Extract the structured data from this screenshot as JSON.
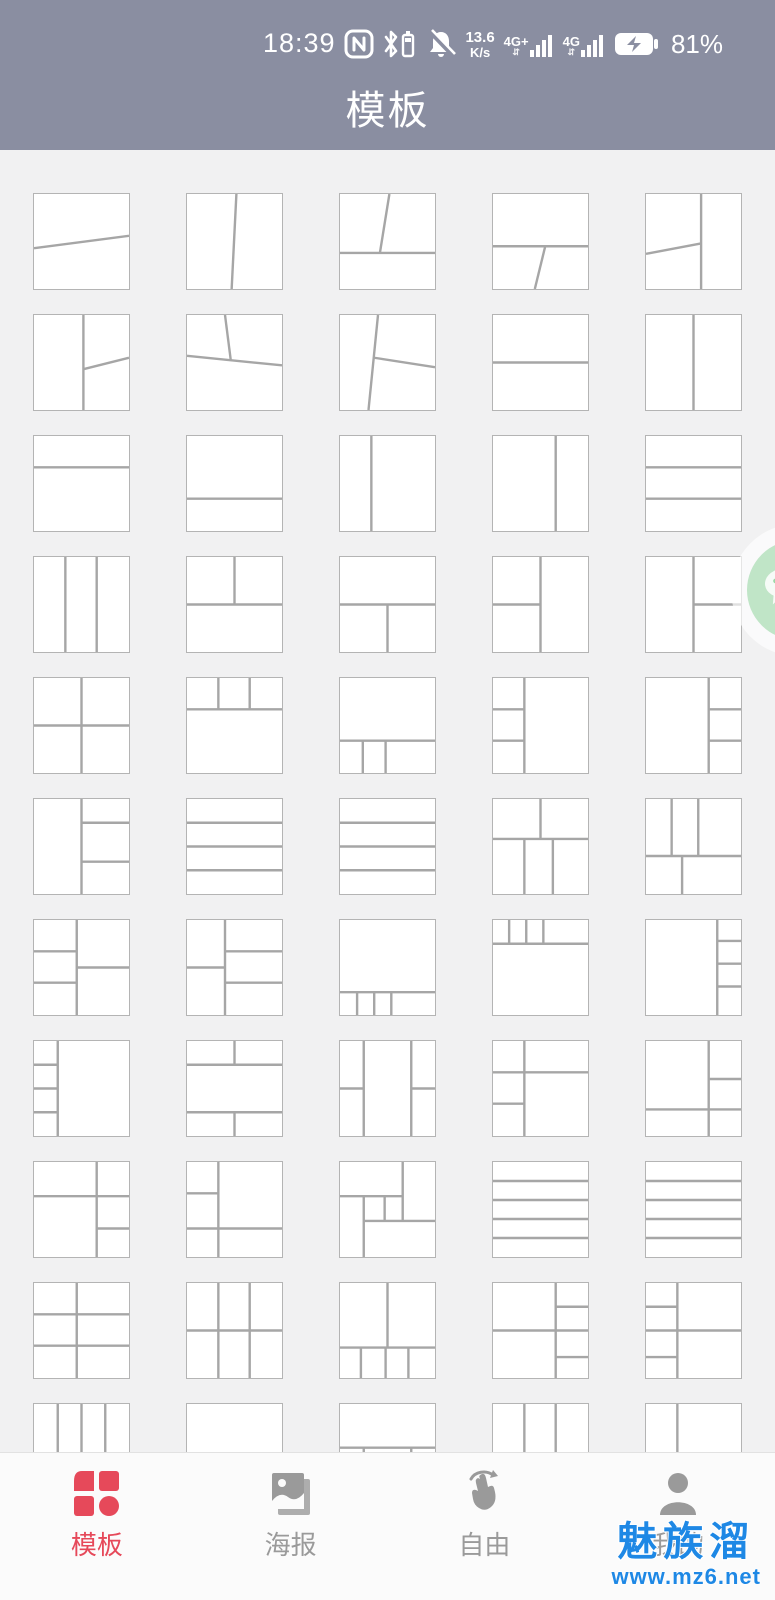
{
  "status_bar": {
    "time": "18:39",
    "speed_value": "13.6",
    "speed_unit": "K/s",
    "net1_label": "4G+",
    "net2_label": "4G",
    "battery_percent": "81%",
    "icons": [
      "nfc-icon",
      "bluetooth-battery-icon",
      "mute-bell-icon",
      "signal-bars-icon",
      "signal-bars-icon",
      "battery-charging-icon"
    ]
  },
  "header": {
    "title": "模板"
  },
  "colors": {
    "header_bg": "#8a8ea1",
    "page_bg": "#f1f1f2",
    "card_border": "#b4b4b4",
    "card_divider": "#a6a6a6",
    "nav_active": "#e6495a",
    "nav_inactive": "#9a9a9a",
    "watermark_blue": "#1e88e5",
    "wechat_green": "#90d39c"
  },
  "templates": [
    {
      "lines": [
        [
          0,
          57,
          100,
          44
        ]
      ]
    },
    {
      "lines": [
        [
          52,
          0,
          47,
          100
        ]
      ]
    },
    {
      "lines": [
        [
          0,
          62,
          100,
          62
        ],
        [
          52,
          0,
          42,
          62
        ]
      ]
    },
    {
      "lines": [
        [
          0,
          55,
          100,
          55
        ],
        [
          55,
          55,
          44,
          100
        ]
      ]
    },
    {
      "lines": [
        [
          58,
          0,
          58,
          100
        ],
        [
          0,
          63,
          58,
          52
        ]
      ]
    },
    {
      "lines": [
        [
          52,
          0,
          52,
          100
        ],
        [
          52,
          57,
          100,
          45
        ]
      ]
    },
    {
      "lines": [
        [
          0,
          43,
          100,
          53
        ],
        [
          40,
          0,
          46,
          47
        ]
      ]
    },
    {
      "lines": [
        [
          40,
          0,
          30,
          100
        ],
        [
          36,
          45,
          100,
          55
        ]
      ]
    },
    {
      "lines": [
        [
          0,
          50,
          100,
          50
        ]
      ]
    },
    {
      "lines": [
        [
          50,
          0,
          50,
          100
        ]
      ]
    },
    {
      "lines": [
        [
          0,
          33,
          100,
          33
        ]
      ]
    },
    {
      "lines": [
        [
          0,
          66,
          100,
          66
        ]
      ]
    },
    {
      "lines": [
        [
          33,
          0,
          33,
          100
        ]
      ]
    },
    {
      "lines": [
        [
          66,
          0,
          66,
          100
        ]
      ]
    },
    {
      "lines": [
        [
          0,
          33,
          100,
          33
        ],
        [
          0,
          66,
          100,
          66
        ]
      ]
    },
    {
      "lines": [
        [
          33,
          0,
          33,
          100
        ],
        [
          66,
          0,
          66,
          100
        ]
      ]
    },
    {
      "lines": [
        [
          0,
          50,
          100,
          50
        ],
        [
          50,
          0,
          50,
          50
        ]
      ]
    },
    {
      "lines": [
        [
          0,
          50,
          100,
          50
        ],
        [
          50,
          50,
          50,
          100
        ]
      ]
    },
    {
      "lines": [
        [
          50,
          0,
          50,
          100
        ],
        [
          0,
          50,
          50,
          50
        ]
      ]
    },
    {
      "lines": [
        [
          50,
          0,
          50,
          100
        ],
        [
          50,
          50,
          100,
          50
        ]
      ]
    },
    {
      "lines": [
        [
          50,
          0,
          50,
          100
        ],
        [
          0,
          50,
          100,
          50
        ]
      ]
    },
    {
      "lines": [
        [
          0,
          33,
          100,
          33
        ],
        [
          33,
          0,
          33,
          33
        ],
        [
          66,
          0,
          66,
          33
        ]
      ]
    },
    {
      "lines": [
        [
          0,
          66,
          100,
          66
        ],
        [
          24,
          66,
          24,
          100
        ],
        [
          48,
          66,
          48,
          100
        ]
      ]
    },
    {
      "lines": [
        [
          33,
          0,
          33,
          100
        ],
        [
          0,
          33,
          33,
          33
        ],
        [
          0,
          66,
          33,
          66
        ]
      ]
    },
    {
      "lines": [
        [
          66,
          0,
          66,
          100
        ],
        [
          66,
          33,
          100,
          33
        ],
        [
          66,
          66,
          100,
          66
        ]
      ]
    },
    {
      "lines": [
        [
          50,
          0,
          50,
          100
        ],
        [
          50,
          25,
          100,
          25
        ],
        [
          50,
          66,
          100,
          66
        ]
      ]
    },
    {
      "lines": [
        [
          0,
          25,
          100,
          25
        ],
        [
          0,
          50,
          100,
          50
        ],
        [
          0,
          75,
          100,
          75
        ]
      ]
    },
    {
      "lines": [
        [
          0,
          25,
          100,
          25
        ],
        [
          0,
          50,
          100,
          50
        ],
        [
          0,
          75,
          100,
          75
        ]
      ]
    },
    {
      "lines": [
        [
          0,
          42,
          100,
          42
        ],
        [
          50,
          0,
          50,
          42
        ],
        [
          33,
          42,
          33,
          100
        ],
        [
          63,
          42,
          63,
          100
        ]
      ]
    },
    {
      "lines": [
        [
          0,
          60,
          100,
          60
        ],
        [
          27,
          0,
          27,
          60
        ],
        [
          55,
          0,
          55,
          60
        ],
        [
          38,
          60,
          38,
          100
        ]
      ]
    },
    {
      "lines": [
        [
          45,
          0,
          45,
          100
        ],
        [
          0,
          33,
          45,
          33
        ],
        [
          0,
          66,
          45,
          66
        ],
        [
          45,
          50,
          100,
          50
        ]
      ]
    },
    {
      "lines": [
        [
          40,
          0,
          40,
          100
        ],
        [
          0,
          50,
          40,
          50
        ],
        [
          40,
          33,
          100,
          33
        ],
        [
          40,
          66,
          100,
          66
        ]
      ]
    },
    {
      "lines": [
        [
          0,
          76,
          100,
          76
        ],
        [
          18,
          76,
          18,
          100
        ],
        [
          36,
          76,
          36,
          100
        ],
        [
          54,
          76,
          54,
          100
        ]
      ]
    },
    {
      "lines": [
        [
          0,
          25,
          100,
          25
        ],
        [
          17,
          0,
          17,
          25
        ],
        [
          35,
          0,
          35,
          25
        ],
        [
          53,
          0,
          53,
          25
        ]
      ]
    },
    {
      "lines": [
        [
          75,
          0,
          75,
          100
        ],
        [
          75,
          22,
          100,
          22
        ],
        [
          75,
          46,
          100,
          46
        ],
        [
          75,
          70,
          100,
          70
        ]
      ]
    },
    {
      "lines": [
        [
          25,
          0,
          25,
          100
        ],
        [
          0,
          25,
          25,
          25
        ],
        [
          0,
          50,
          25,
          50
        ],
        [
          0,
          75,
          25,
          75
        ]
      ]
    },
    {
      "lines": [
        [
          0,
          25,
          100,
          25
        ],
        [
          0,
          75,
          100,
          75
        ],
        [
          50,
          0,
          50,
          25
        ],
        [
          50,
          75,
          50,
          100
        ]
      ]
    },
    {
      "lines": [
        [
          25,
          0,
          25,
          100
        ],
        [
          75,
          0,
          75,
          100
        ],
        [
          0,
          50,
          25,
          50
        ],
        [
          75,
          50,
          100,
          50
        ]
      ]
    },
    {
      "lines": [
        [
          33,
          0,
          33,
          100
        ],
        [
          0,
          33,
          100,
          33
        ],
        [
          0,
          66,
          33,
          66
        ]
      ]
    },
    {
      "lines": [
        [
          66,
          0,
          66,
          100
        ],
        [
          66,
          40,
          100,
          40
        ],
        [
          0,
          72,
          100,
          72
        ]
      ]
    },
    {
      "lines": [
        [
          66,
          0,
          66,
          100
        ],
        [
          0,
          36,
          100,
          36
        ],
        [
          66,
          70,
          100,
          70
        ]
      ]
    },
    {
      "lines": [
        [
          33,
          0,
          33,
          100
        ],
        [
          0,
          33,
          33,
          33
        ],
        [
          0,
          70,
          100,
          70
        ]
      ]
    },
    {
      "lines": [
        [
          0,
          36,
          66,
          36
        ],
        [
          66,
          0,
          66,
          62
        ],
        [
          25,
          62,
          100,
          62
        ],
        [
          25,
          36,
          25,
          100
        ],
        [
          47,
          36,
          47,
          62
        ]
      ]
    },
    {
      "lines": [
        [
          0,
          20,
          100,
          20
        ],
        [
          0,
          40,
          100,
          40
        ],
        [
          0,
          60,
          100,
          60
        ],
        [
          0,
          80,
          100,
          80
        ]
      ]
    },
    {
      "lines": [
        [
          0,
          20,
          100,
          20
        ],
        [
          0,
          40,
          100,
          40
        ],
        [
          0,
          60,
          100,
          60
        ],
        [
          0,
          80,
          100,
          80
        ]
      ]
    },
    {
      "lines": [
        [
          45,
          0,
          45,
          100
        ],
        [
          0,
          33,
          100,
          33
        ],
        [
          0,
          66,
          100,
          66
        ]
      ]
    },
    {
      "lines": [
        [
          33,
          0,
          33,
          100
        ],
        [
          66,
          0,
          66,
          100
        ],
        [
          0,
          50,
          100,
          50
        ]
      ]
    },
    {
      "lines": [
        [
          50,
          0,
          50,
          68
        ],
        [
          0,
          68,
          100,
          68
        ],
        [
          22,
          68,
          22,
          100
        ],
        [
          48,
          68,
          48,
          100
        ],
        [
          72,
          68,
          72,
          100
        ]
      ]
    },
    {
      "lines": [
        [
          66,
          0,
          66,
          100
        ],
        [
          0,
          50,
          100,
          50
        ],
        [
          66,
          25,
          100,
          25
        ],
        [
          66,
          78,
          100,
          78
        ]
      ]
    },
    {
      "lines": [
        [
          33,
          0,
          33,
          100
        ],
        [
          0,
          50,
          100,
          50
        ],
        [
          0,
          25,
          33,
          25
        ],
        [
          0,
          78,
          33,
          78
        ]
      ]
    },
    {
      "lines": [
        [
          25,
          0,
          25,
          100
        ],
        [
          50,
          0,
          50,
          100
        ],
        [
          75,
          0,
          75,
          100
        ]
      ]
    },
    {
      "lines": []
    },
    {
      "lines": [
        [
          0,
          46,
          100,
          46
        ],
        [
          25,
          46,
          25,
          100
        ],
        [
          75,
          46,
          75,
          100
        ]
      ]
    },
    {
      "lines": [
        [
          33,
          0,
          33,
          100
        ],
        [
          66,
          0,
          66,
          100
        ]
      ]
    },
    {
      "lines": [
        [
          33,
          0,
          33,
          100
        ]
      ]
    }
  ],
  "bottom_nav": {
    "items": [
      {
        "label": "模板",
        "icon": "template-grid-icon",
        "active": true
      },
      {
        "label": "海报",
        "icon": "poster-photo-icon",
        "active": false
      },
      {
        "label": "自由",
        "icon": "free-gesture-icon",
        "active": false
      },
      {
        "label": "我的",
        "icon": "profile-person-icon",
        "active": false
      }
    ]
  },
  "watermark": {
    "line1": "魅族溜",
    "line2": "www.mz6.net"
  },
  "float_button": {
    "name": "wechat-float-button"
  }
}
